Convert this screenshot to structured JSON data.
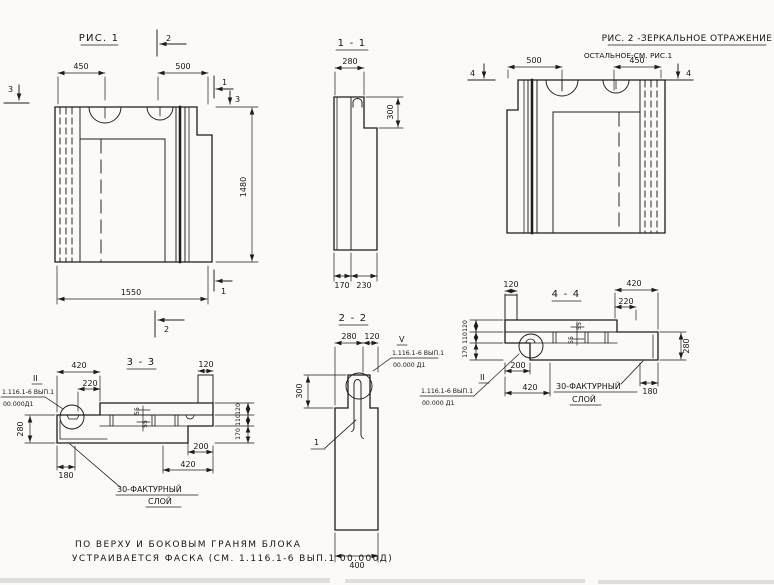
{
  "drawing": {
    "fig1": {
      "title": "РИС. 1",
      "dim_left": "450",
      "dim_right": "500",
      "dim_height": "1480",
      "dim_width": "1550",
      "mark_cut_top": "2",
      "mark_cut_bottom": "2",
      "mark_cut_right_top": "1",
      "mark_cut_right_bottom": "1",
      "mark_cut_left": "3",
      "mark_cut_right": "3"
    },
    "sec11": {
      "title": "1 - 1",
      "dim_width": "280",
      "dim_top_height": "300",
      "dim_bottom_left": "170",
      "dim_bottom_right": "230"
    },
    "fig2": {
      "title": "РИС. 2 -ЗЕРКАЛЬНОЕ ОТРАЖЕНИЕ",
      "subtitle": "ОСТАЛЬНОЕ-СМ. РИС.1",
      "dim_left": "500",
      "dim_right": "450",
      "mark_cut_left": "4",
      "mark_cut_right": "4"
    },
    "sec33": {
      "title": "3 - 3",
      "dim_420_top": "420",
      "dim_220": "220",
      "dim_120_top": "120",
      "dim_thickness": "280",
      "stack": [
        "120",
        "110",
        "170"
      ],
      "dim_55_a": "55",
      "dim_55_b": "55",
      "dim_180": "180",
      "dim_200": "200",
      "dim_420_bottom": "420",
      "detail_mark": "II",
      "callout_series": "1.116.1-6 ВЫП.1",
      "callout_sheet": "00.000Д1",
      "note_line1": "30-ФАКТУРНЫЙ",
      "note_line2": "СЛОЙ"
    },
    "sec22": {
      "title": "2 - 2",
      "dim_280": "280",
      "dim_120": "120",
      "dim_300": "300",
      "dim_400": "400",
      "detail_mark": "V",
      "callout_series": "1.116.1-6 ВЫП.1",
      "callout_sheet": "00.000 Д1",
      "loop_mark": "1"
    },
    "sec44": {
      "title": "4 - 4",
      "dim_120_top": "120",
      "dim_420_top": "420",
      "dim_220": "220",
      "dim_thickness": "280",
      "stack": [
        "120",
        "110",
        "170"
      ],
      "dim_55_a": "55",
      "dim_55_b": "55",
      "dim_200": "200",
      "dim_420_bottom": "420",
      "dim_180": "180",
      "detail_mark": "II",
      "callout_series": "1.116.1-6 ВЫП.1",
      "callout_sheet": "00.000 Д1",
      "note_line1": "30-ФАКТУРНЫЙ",
      "note_line2": "СЛОЙ"
    },
    "footer": {
      "line1": "ПО ВЕРХУ И БОКОВЫМ ГРАНЯМ БЛОКА",
      "line2": "УСТРАИВАЕТСЯ ФАСКА (СМ. 1.116.1-6 ВЫП.1 00.000Д)"
    }
  }
}
